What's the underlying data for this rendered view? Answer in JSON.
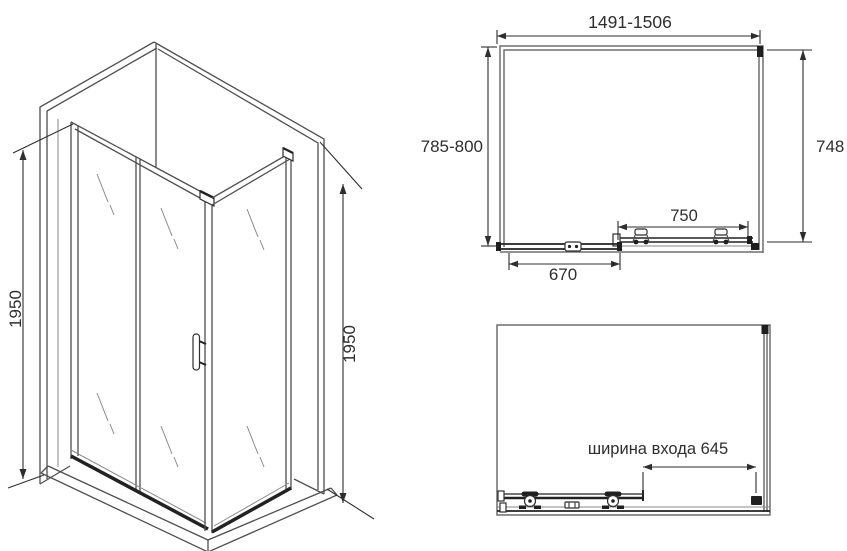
{
  "colors": {
    "background": "#ffffff",
    "line": "#4f4f4f",
    "wall_line": "#6e6e6e",
    "dark_profile": "#1f1f1f",
    "dimension_text": "#2e2e2e"
  },
  "views": {
    "perspective": {
      "height_left": "1950",
      "height_right": "1950"
    },
    "plan": {
      "width_range": "1491-1506",
      "depth_range": "785-800",
      "side_inner_depth": "748",
      "sliding_door_width": "750",
      "fixed_panel_width": "670"
    },
    "elevation": {
      "entrance_width_label": "ширина входа 645"
    }
  }
}
